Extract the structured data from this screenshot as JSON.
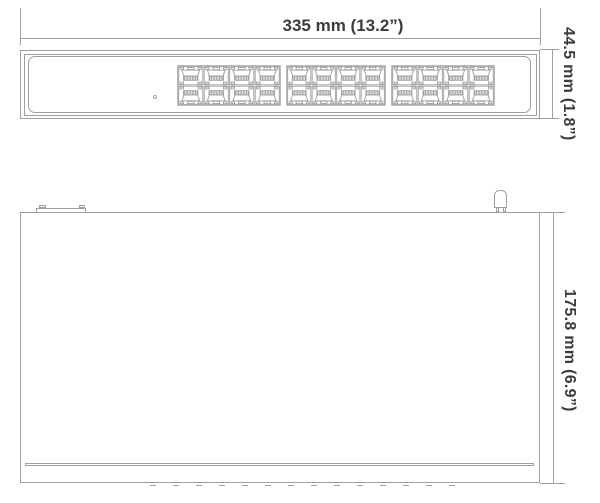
{
  "front_view": {
    "width_label": "335 mm (13.2”)",
    "height_label": "44.5 mm (1.8”)",
    "port_groups": 3,
    "port_columns": 4,
    "port_rows": 2
  },
  "top_view": {
    "depth_label": "175.8 mm (6.9”)"
  },
  "colors": {
    "line": "#9f9f9f",
    "text": "#3c3c3c",
    "background": "#ffffff"
  }
}
